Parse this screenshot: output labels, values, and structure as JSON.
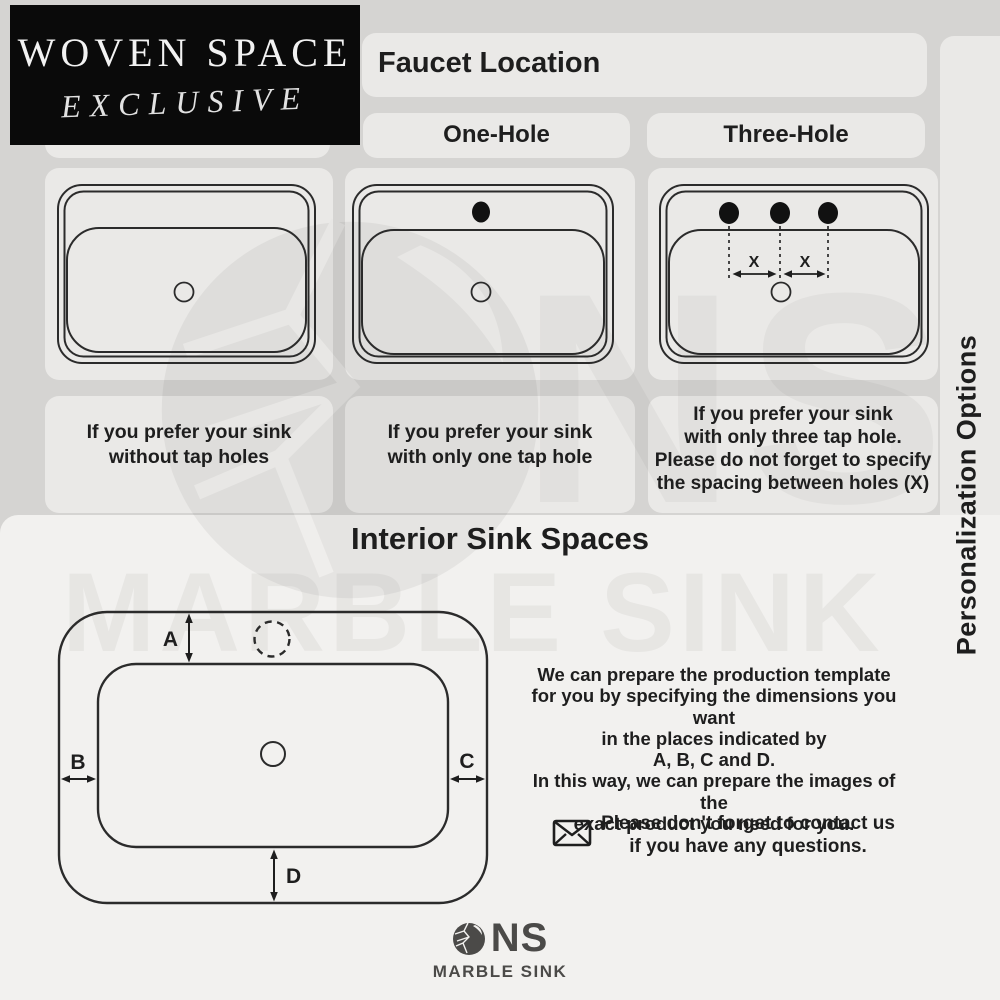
{
  "brand_box": {
    "line1": "WOVEN SPACE",
    "line2": "EXCLUSIVE"
  },
  "faucet_section": {
    "title": "Faucet Location",
    "column_labels": [
      "One-Hole",
      "Three-Hole"
    ],
    "options": [
      {
        "name": "no-hole",
        "caption_lines": [
          "If you prefer your sink",
          "without tap holes"
        ]
      },
      {
        "name": "one-hole",
        "caption_lines": [
          "If you prefer your sink",
          "with only one tap hole"
        ]
      },
      {
        "name": "three-hole",
        "caption_lines": [
          "If you prefer your sink",
          "with only three tap hole.",
          "Please do not forget to specify",
          "the spacing between holes (X)"
        ],
        "spacing_label": "X"
      }
    ]
  },
  "interior_section": {
    "title": "Interior Sink Spaces",
    "dimension_labels": {
      "a": "A",
      "b": "B",
      "c": "C",
      "d": "D"
    },
    "description_lines": [
      "We can prepare the production template",
      "for you by specifying the dimensions you want",
      "in the places indicated by",
      "A, B, C and D.",
      "In this way, we can prepare the images of the",
      "exact product you need for you."
    ],
    "contact_lines": [
      "Please don't forget to contact us",
      "if you have any questions."
    ]
  },
  "side_banner": {
    "text": "Personalization Options"
  },
  "watermark": {
    "initials": "NS",
    "name": "MARBLE SINK"
  },
  "footer_logo": {
    "initials": "NS",
    "name": "MARBLE SINK"
  },
  "colors": {
    "background_top": "#d5d4d2",
    "card": "#eae9e7",
    "background_bottom": "#f2f1ef",
    "ink": "#1e1e1e",
    "logo_gray": "#4b4a48",
    "brand_box_bg": "#0a0a0a",
    "brand_text": "#f2f2f2"
  }
}
